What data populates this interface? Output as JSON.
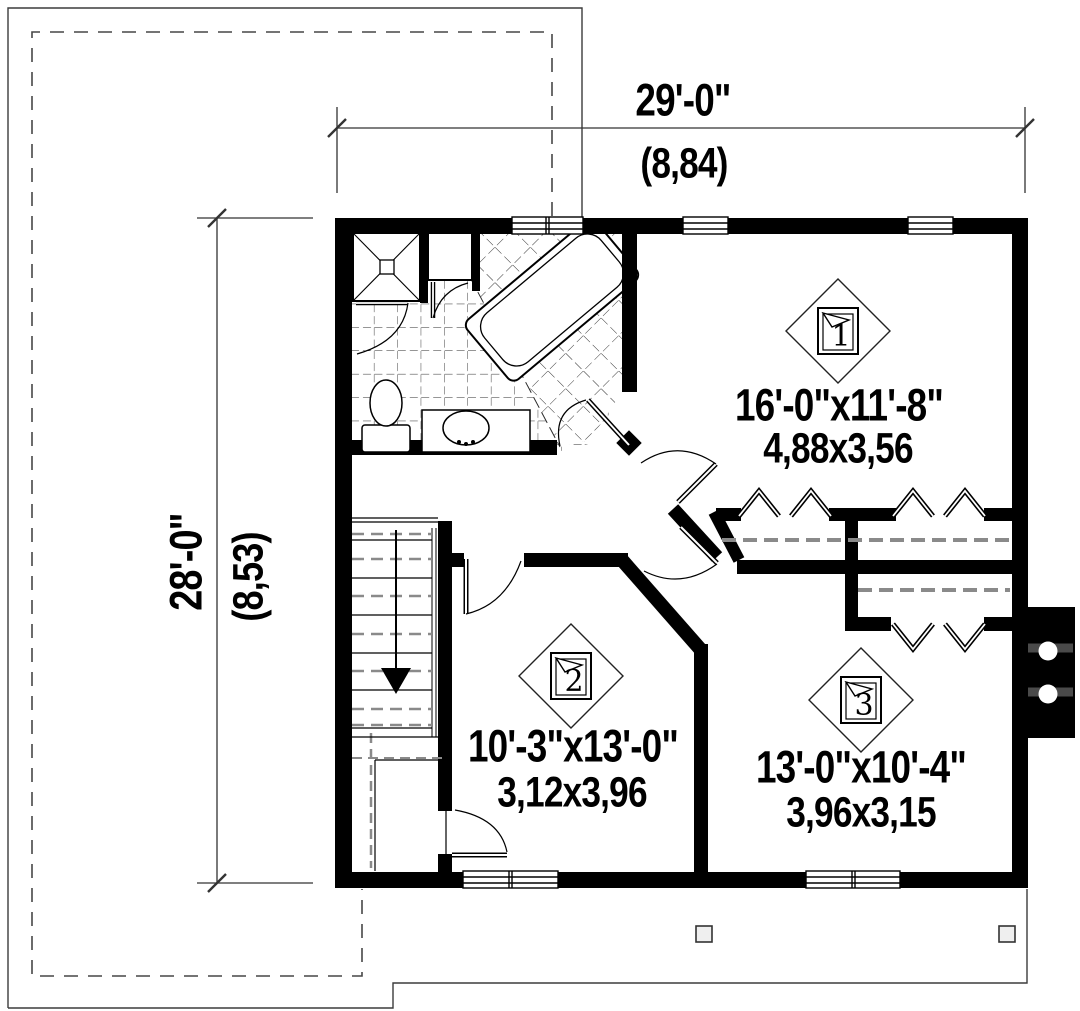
{
  "plan": {
    "title": "second floor plan",
    "dimensions": {
      "top": {
        "imperial": "29'-0\"",
        "metric": "(8,84)"
      },
      "left": {
        "imperial": "28'-0\"",
        "metric": "(8,53)"
      }
    },
    "rooms": [
      {
        "marker": "1",
        "imperial": "16'-0\"x11'-8\"",
        "metric": "4,88x3,56"
      },
      {
        "marker": "2",
        "imperial": "10'-3\"x13'-0\"",
        "metric": "3,12x3,96"
      },
      {
        "marker": "3",
        "imperial": "13'-0\"x10'-4\"",
        "metric": "3,96x3,15"
      }
    ],
    "colors": {
      "wall": "#000000",
      "line": "#333333",
      "rod_gray": "#8a8a8a"
    }
  }
}
